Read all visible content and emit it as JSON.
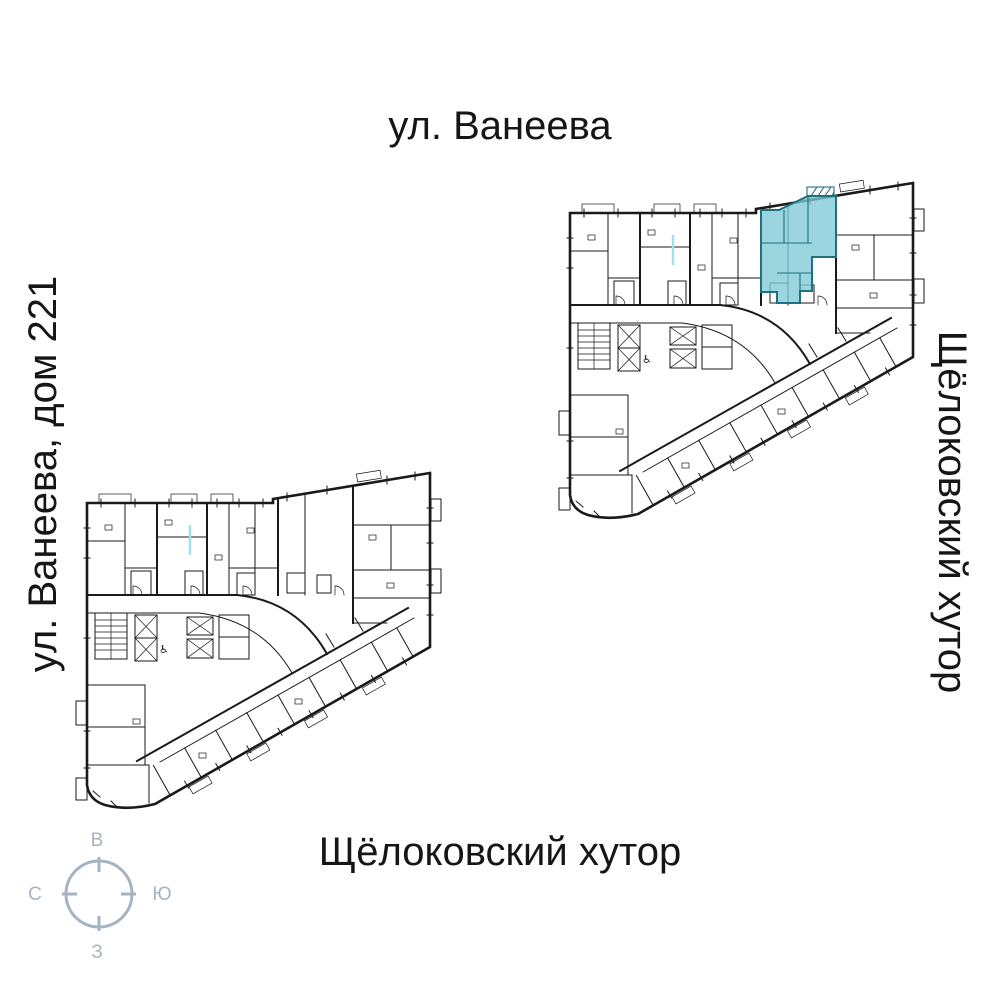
{
  "page": {
    "width": 1000,
    "height": 1000,
    "background": "#ffffff"
  },
  "labels": {
    "street_top": "ул. Ванеева",
    "address_left": "ул. Ванеева, дом 221",
    "district_right": "Щёлоковский хутор",
    "district_bottom": "Щёлоковский хутор"
  },
  "compass": {
    "top": "В",
    "right": "Ю",
    "bottom": "З",
    "left": "С"
  },
  "icons": {
    "wheelchair": "♿"
  },
  "plans": {
    "upper": {
      "id": "floor-plan-upper",
      "has_highlighted_unit": true
    },
    "lower": {
      "id": "floor-plan-lower",
      "has_highlighted_unit": false
    }
  },
  "colors": {
    "ink": "#1a1a1a",
    "highlight_fill": "#7fc9d6",
    "highlight_stroke": "#1f7080",
    "glass_line": "#9fdff0",
    "compass": "#a6b4c2"
  }
}
